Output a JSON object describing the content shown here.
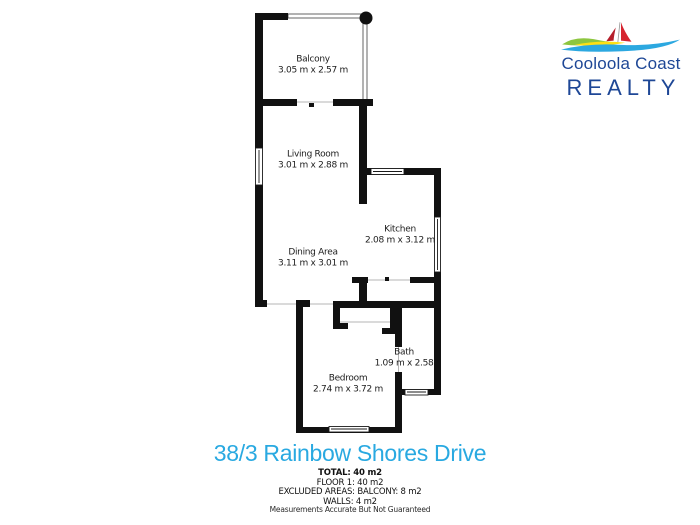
{
  "logo": {
    "line1": "Cooloola Coast",
    "line2": "REALTY",
    "icon": "sailboat-waves-logo",
    "colors": {
      "navy": "#1E4796",
      "sail_red": "#D62530",
      "sail_dark_red": "#B51E2B",
      "wave_green": "#8DC63F",
      "wave_yellow": "#FFE012",
      "wave_blue": "#2CA8E0"
    }
  },
  "plan": {
    "wall_color": "#111111",
    "rooms": [
      {
        "name": "Balcony",
        "dims": "3.05 m x 2.57 m"
      },
      {
        "name": "Living Room",
        "dims": "3.01 m x 2.88 m"
      },
      {
        "name": "Kitchen",
        "dims": "2.08 m x 3.12 m"
      },
      {
        "name": "Dining Area",
        "dims": "3.11 m x 3.01 m"
      },
      {
        "name": "Bath",
        "dims": "1.09 m x 2.58"
      },
      {
        "name": "Bedroom",
        "dims": "2.74 m x 3.72 m"
      }
    ]
  },
  "footer": {
    "title": "38/3 Rainbow Shores Drive",
    "title_color": "#29A9E1",
    "summary": [
      "TOTAL: 40 m2",
      "FLOOR 1: 40 m2",
      "EXCLUDED AREAS: BALCONY: 8 m2",
      "WALLS: 4 m2"
    ],
    "disclaimer": "Measurements Accurate But Not Guaranteed"
  }
}
